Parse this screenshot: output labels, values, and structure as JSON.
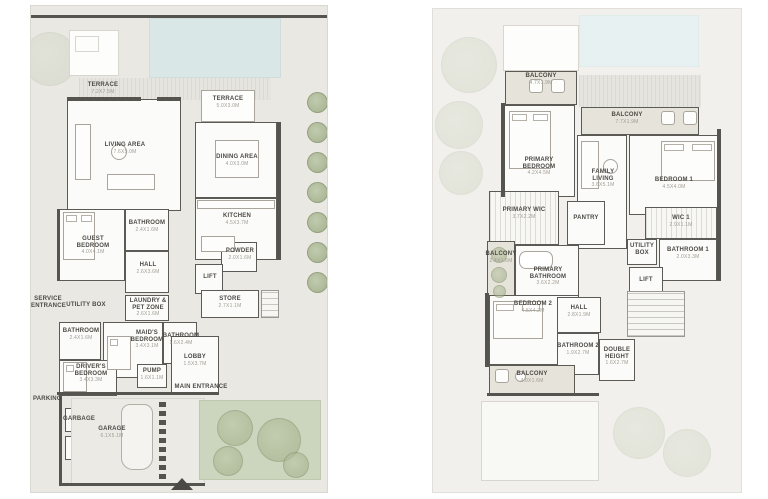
{
  "colors": {
    "plot_ground": "#e9e8e3",
    "plot_first": "#f1f0ec",
    "wall": "#56544e",
    "pool": "#d9e8e7",
    "garden": "#ccd5bd",
    "balcony_fill": "#e6e3da",
    "room_fill": "#fbfbf9",
    "label_text": "#4c4a45",
    "dim_text": "#a09c93"
  },
  "plans": {
    "ground": {
      "rooms": [
        {
          "label": "TERRACE",
          "dim": "7.2X7.5M"
        },
        {
          "label": "TERRACE",
          "dim": "5.0X3.0M"
        },
        {
          "label": "LIVING AREA",
          "dim": "7.6X5.0M"
        },
        {
          "label": "DINING AREA",
          "dim": "4.0X3.0M"
        },
        {
          "label": "KITCHEN",
          "dim": "4.5X3.7M"
        },
        {
          "label": "GUEST BEDROOM",
          "dim": "4.0X4.1M"
        },
        {
          "label": "BATHROOM",
          "dim": "2.4X1.6M"
        },
        {
          "label": "HALL",
          "dim": "2.6X3.6M"
        },
        {
          "label": "POWDER",
          "dim": "2.0X1.6M"
        },
        {
          "label": "LIFT"
        },
        {
          "label": "STORE",
          "dim": "2.7X1.1M"
        },
        {
          "label": "SERVICE ENTRANCE"
        },
        {
          "label": "UTILITY BOX"
        },
        {
          "label": "LAUNDRY & PET ZONE",
          "dim": "2.6X1.6M"
        },
        {
          "label": "BATHROOM",
          "dim": "2.4X1.6M"
        },
        {
          "label": "MAID'S BEDROOM",
          "dim": "3.4X3.1M"
        },
        {
          "label": "BATHROOM",
          "dim": "1.6X2.4M"
        },
        {
          "label": "DRIVER'S BEDROOM",
          "dim": "3.4X3.3M"
        },
        {
          "label": "PUMP",
          "dim": "1.6X1.1M"
        },
        {
          "label": "LOBBY",
          "dim": "1.5X3.7M"
        },
        {
          "label": "MAIN ENTRANCE"
        },
        {
          "label": "PARKING"
        },
        {
          "label": "GARBAGE"
        },
        {
          "label": "GARAGE",
          "dim": "6.1X5.1M"
        }
      ]
    },
    "first": {
      "rooms": [
        {
          "label": "BALCONY",
          "dim": "4.7X1.9M"
        },
        {
          "label": "BALCONY",
          "dim": "7.7X1.9M"
        },
        {
          "label": "PRIMARY BEDROOM",
          "dim": "4.2X4.5M"
        },
        {
          "label": "FAMILY LIVING",
          "dim": "3.6X5.1M"
        },
        {
          "label": "BEDROOM 1",
          "dim": "4.5X4.0M"
        },
        {
          "label": "PRIMARY WIC",
          "dim": "3.7X2.2M"
        },
        {
          "label": "PANTRY"
        },
        {
          "label": "WIC 1",
          "dim": "2.9X1.1M"
        },
        {
          "label": "UTILITY BOX"
        },
        {
          "label": "BATHROOM 1",
          "dim": "2.0X3.3M"
        },
        {
          "label": "LIFT"
        },
        {
          "label": "PRIMARY BATHROOM",
          "dim": "3.6X2.2M"
        },
        {
          "label": "BALCONY",
          "dim": "2.4X1.6M"
        },
        {
          "label": "BEDROOM 2",
          "dim": "4.5X4.2M"
        },
        {
          "label": "HALL",
          "dim": "2.8X1.9M"
        },
        {
          "label": "BATHROOM 2",
          "dim": "1.9X2.7M"
        },
        {
          "label": "DOUBLE HEIGHT",
          "dim": "1.6X2.7M"
        },
        {
          "label": "BALCONY",
          "dim": "4.0X1.6M"
        }
      ]
    }
  }
}
